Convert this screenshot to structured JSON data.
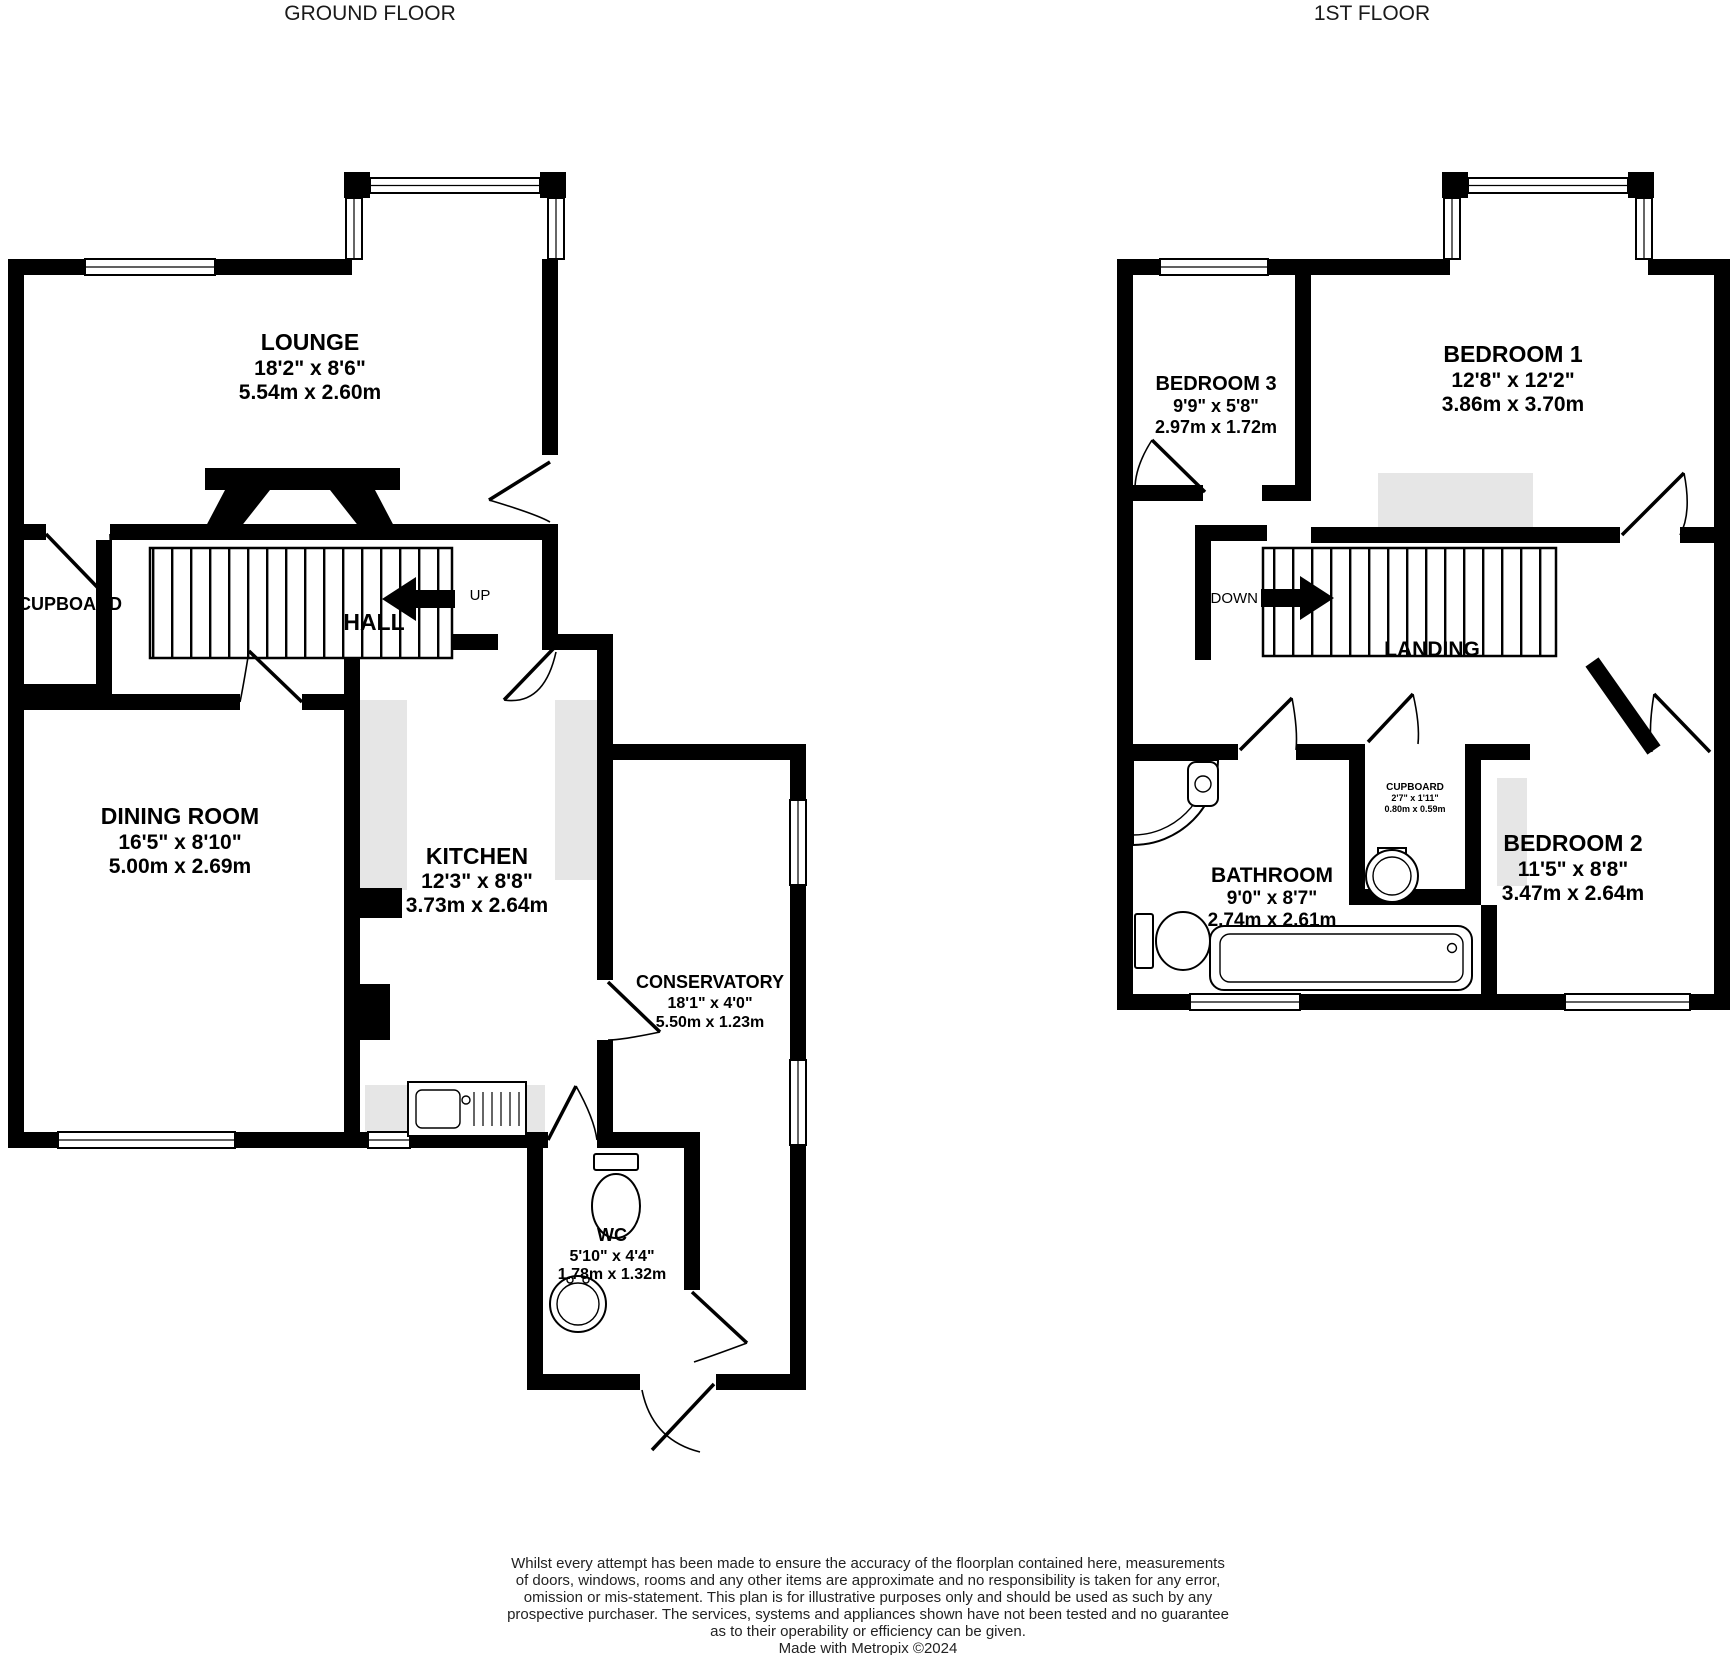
{
  "page": {
    "background": "#ffffff",
    "wall_color": "#000000",
    "accent_gray": "#e6e6e6",
    "text_color": "#000000"
  },
  "ground_floor": {
    "title": "GROUND FLOOR",
    "stair_direction": "UP",
    "rooms": {
      "lounge": {
        "name": "LOUNGE",
        "imperial": "18'2\" x 8'6\"",
        "metric": "5.54m x 2.60m"
      },
      "dining_room": {
        "name": "DINING ROOM",
        "imperial": "16'5\" x 8'10\"",
        "metric": "5.00m x 2.69m"
      },
      "kitchen": {
        "name": "KITCHEN",
        "imperial": "12'3\" x 8'8\"",
        "metric": "3.73m x 2.64m"
      },
      "conservatory": {
        "name": "CONSERVATORY",
        "imperial": "18'1\" x 4'0\"",
        "metric": "5.50m x 1.23m"
      },
      "wc": {
        "name": "WC",
        "imperial": "5'10\" x 4'4\"",
        "metric": "1.78m x 1.32m"
      },
      "hall": {
        "name": "HALL"
      },
      "cupboard": {
        "name": "CUPBOARD"
      }
    }
  },
  "first_floor": {
    "title": "1ST FLOOR",
    "stair_direction": "DOWN",
    "rooms": {
      "bedroom_1": {
        "name": "BEDROOM 1",
        "imperial": "12'8\" x 12'2\"",
        "metric": "3.86m x 3.70m"
      },
      "bedroom_2": {
        "name": "BEDROOM 2",
        "imperial": "11'5\" x 8'8\"",
        "metric": "3.47m x 2.64m"
      },
      "bedroom_3": {
        "name": "BEDROOM 3",
        "imperial": "9'9\" x 5'8\"",
        "metric": "2.97m x 1.72m"
      },
      "bathroom": {
        "name": "BATHROOM",
        "imperial": "9'0\" x 8'7\"",
        "metric": "2.74m x 2.61m"
      },
      "landing": {
        "name": "LANDING"
      },
      "cupboard": {
        "name": "CUPBOARD",
        "imperial": "2'7\" x 1'11\"",
        "metric": "0.80m x 0.59m"
      }
    }
  },
  "disclaimer": {
    "lines": [
      "Whilst every attempt has been made to ensure the accuracy of the floorplan contained here, measurements",
      "of doors, windows, rooms and any other items are approximate and no responsibility is taken for any error,",
      "omission or mis-statement. This plan is for illustrative purposes only and should be used as such by any",
      "prospective purchaser. The services, systems and appliances shown have not been tested and no guarantee",
      "as to their operability or efficiency can be given.",
      "Made with Metropix ©2024"
    ]
  }
}
